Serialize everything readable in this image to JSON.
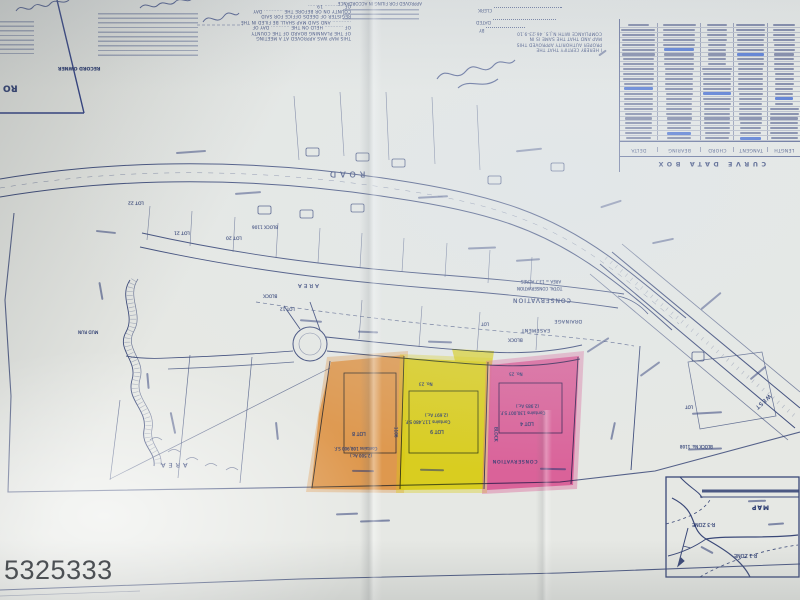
{
  "watermark": "5325333",
  "palette": {
    "paper": "#e6e8e4",
    "ink": "#3a4878",
    "highlight_orange": "#f59b3e",
    "highlight_yellow": "#f0df0c",
    "highlight_pink": "#f0569f",
    "watermark_color": "#414549"
  },
  "curve_table": {
    "title": "CURVE DATA BOX",
    "columns": [
      "DELTA",
      "BEARING",
      "CHORD",
      "TANGENT",
      "LENGTH"
    ],
    "row_count": 24,
    "note": "rows of tiny illegible curve numbers"
  },
  "certifications": {
    "planning_board_note": [
      "THIS MAP WAS APPROVED AT A MEETING",
      "OF THE PLANNING BOARD OF THE COUNTY",
      "OF ............ HELD ON THE ............ DAY OF",
      "............ AND SAID MAP SHALL BE FILED IN THE",
      "REGISTER OF DEEDS OFFICE FOR SAID",
      "COUNTY ON OR BEFORE THE ............ DAY",
      "OF ............ 19......"
    ],
    "authority_note": [
      "I HEREBY CERTIFY THAT THE",
      "PROPER AUTHORITY APPROVED THIS",
      "MAP AND THAT THE SAME IS IN",
      "COMPLIANCE WITH N.J.S. 46:23-9.10"
    ],
    "approved_note": "APPROVED FOR FILING IN ACCORDANCE",
    "clerk_label": "CLERK",
    "dated_label": "DATED",
    "by_label": "BY"
  },
  "highlighted_lots": [
    {
      "lot": "LOT 8",
      "block": "1106",
      "area_sf": "Contains 108,900 S.F.",
      "acres": "(2.500 Ac.)",
      "highlight": "orange"
    },
    {
      "lot": "LOT 9",
      "block": "1106",
      "area_sf": "Contains 117,480 S.F.",
      "acres": "(2.697 Ac.)",
      "highlight": "yellow"
    },
    {
      "lot": "LOT 4",
      "block": "1106",
      "area_sf": "Contains 130,007 S.F.",
      "acres": "(2.985 Ac.)",
      "highlight": "pink"
    }
  ],
  "inset": {
    "title": "MAP",
    "zones": [
      "R-3 ZONE",
      "R-1 ZONE"
    ]
  },
  "map_labels": [
    {
      "text": "ROAD",
      "x": 326,
      "y": 169,
      "fs": 8,
      "ls": 4,
      "name": "road-name-label"
    },
    {
      "text": "LOT 22",
      "x": 128,
      "y": 199,
      "fs": 4.5
    },
    {
      "text": "LOT 21",
      "x": 174,
      "y": 229,
      "fs": 4.5
    },
    {
      "text": "LOT 20",
      "x": 226,
      "y": 234,
      "fs": 4.5
    },
    {
      "text": "BLOCK 1106",
      "x": 252,
      "y": 224,
      "fs": 4.2,
      "name": "block-number-label"
    },
    {
      "text": "AREA",
      "x": 296,
      "y": 281,
      "fs": 5.5,
      "ls": 2
    },
    {
      "text": "BLOCK",
      "x": 263,
      "y": 292,
      "fs": 4.3
    },
    {
      "text": "LOT 12",
      "x": 280,
      "y": 306,
      "fs": 4.2
    },
    {
      "text": "AREA = 13.7 ACRES",
      "x": 521,
      "y": 279,
      "fs": 4
    },
    {
      "text": "TOTAL CONSERVATION",
      "x": 517,
      "y": 286,
      "fs": 4
    },
    {
      "text": "CONSERVATION",
      "x": 512,
      "y": 296,
      "fs": 6,
      "ls": 1,
      "name": "conservation-area-label"
    },
    {
      "text": "DRAINAGE",
      "x": 554,
      "y": 317,
      "fs": 4.6,
      "ls": 0.5
    },
    {
      "text": "EASEMENT",
      "x": 521,
      "y": 326,
      "fs": 4.6,
      "ls": 0.5
    },
    {
      "text": "LOT",
      "x": 481,
      "y": 321,
      "fs": 4.2
    },
    {
      "text": "BLOCK",
      "x": 508,
      "y": 336,
      "fs": 4.4
    },
    {
      "text": "No. 23",
      "x": 419,
      "y": 381,
      "fs": 4.2
    },
    {
      "text": "No. 25",
      "x": 509,
      "y": 371,
      "fs": 4.2
    },
    {
      "text": "(2.697 Ac.)",
      "x": 425,
      "y": 412,
      "fs": 4.2
    },
    {
      "text": "Contains 117,480 S.F.",
      "x": 405,
      "y": 419,
      "fs": 4.2
    },
    {
      "text": "LOT 9",
      "x": 430,
      "y": 428,
      "fs": 4.8,
      "name": "lot-9-label"
    },
    {
      "text": "LOT 8",
      "x": 352,
      "y": 430,
      "fs": 4.8,
      "name": "lot-8-label"
    },
    {
      "text": "Contains 108,900 S.F.",
      "x": 334,
      "y": 446,
      "fs": 4
    },
    {
      "text": "(2.500 Ac.)",
      "x": 350,
      "y": 453,
      "fs": 4
    },
    {
      "text": "(2.985 Ac.)",
      "x": 516,
      "y": 403,
      "fs": 4.2
    },
    {
      "text": "Contains 130,007 S.F.",
      "x": 500,
      "y": 410,
      "fs": 4.2
    },
    {
      "text": "LOT 4",
      "x": 520,
      "y": 420,
      "fs": 4.8,
      "name": "lot-4-label"
    },
    {
      "text": "BLOCK",
      "x": 487,
      "y": 432,
      "fs": 4.4,
      "rot": 90,
      "name": "block-label-vertical"
    },
    {
      "text": "1106",
      "x": 390,
      "y": 430,
      "fs": 4.2,
      "rot": 90
    },
    {
      "text": "CONSERVATION",
      "x": 492,
      "y": 457,
      "fs": 4.6,
      "ls": 0.8
    },
    {
      "text": "WEST",
      "x": 752,
      "y": 398,
      "fs": 5.5,
      "ls": 1,
      "rot": 138,
      "name": "west-road-label"
    },
    {
      "text": "LOT",
      "x": 685,
      "y": 404,
      "fs": 4.2
    },
    {
      "text": "BLOCK No. 1108",
      "x": 680,
      "y": 444,
      "fs": 4
    },
    {
      "text": "MUD RUN",
      "x": 78,
      "y": 329,
      "fs": 4.2,
      "name": "stream-label"
    },
    {
      "text": "AREA",
      "x": 158,
      "y": 461,
      "fs": 6.5,
      "ls": 3
    },
    {
      "text": "MAP",
      "x": 751,
      "y": 503,
      "fs": 6,
      "ls": 1,
      "cls": "b",
      "name": "inset-map-title"
    },
    {
      "text": "R-3 ZONE",
      "x": 692,
      "y": 521,
      "fs": 4.8,
      "name": "zone-r3-label"
    },
    {
      "text": "R-1 ZONE",
      "x": 734,
      "y": 552,
      "fs": 4.8,
      "name": "zone-r1-label"
    },
    {
      "text": "RO",
      "x": 3,
      "y": 82,
      "fs": 9,
      "cls": "b",
      "name": "corner-box-text"
    },
    {
      "text": "RECORD OWNER",
      "x": 58,
      "y": 64,
      "fs": 4.6,
      "cls": "b",
      "name": "record-owner-label"
    }
  ],
  "smudges": [
    {
      "x": 235,
      "y": 192,
      "w": 26,
      "r": -4
    },
    {
      "x": 418,
      "y": 196,
      "w": 30,
      "r": -3
    },
    {
      "x": 468,
      "y": 247,
      "w": 28,
      "r": -2
    },
    {
      "x": 516,
      "y": 259,
      "w": 24,
      "r": -4
    },
    {
      "x": 96,
      "y": 231,
      "w": 20,
      "r": 6
    },
    {
      "x": 176,
      "y": 151,
      "w": 30,
      "r": -4
    },
    {
      "x": 516,
      "y": 149,
      "w": 26,
      "r": -6
    },
    {
      "x": 600,
      "y": 203,
      "w": 22,
      "r": -18
    },
    {
      "x": 652,
      "y": 240,
      "w": 22,
      "r": -12
    },
    {
      "x": 300,
      "y": 320,
      "w": 22,
      "r": 4
    },
    {
      "x": 358,
      "y": 331,
      "w": 20,
      "r": 2
    },
    {
      "x": 428,
      "y": 341,
      "w": 24,
      "r": 2
    },
    {
      "x": 585,
      "y": 344,
      "w": 26,
      "r": -33
    },
    {
      "x": 638,
      "y": 368,
      "w": 24,
      "r": -36
    },
    {
      "x": 698,
      "y": 300,
      "w": 26,
      "r": -40
    },
    {
      "x": 748,
      "y": 372,
      "w": 20,
      "r": -40
    },
    {
      "x": 692,
      "y": 412,
      "w": 30,
      "r": -3
    },
    {
      "x": 688,
      "y": 448,
      "w": 34,
      "r": -2
    },
    {
      "x": 604,
      "y": 430,
      "w": 18,
      "r": -78
    },
    {
      "x": 162,
      "y": 422,
      "w": 22,
      "r": 78
    },
    {
      "x": 268,
      "y": 430,
      "w": 18,
      "r": 84
    },
    {
      "x": 540,
      "y": 468,
      "w": 26,
      "r": 1
    },
    {
      "x": 420,
      "y": 469,
      "w": 24,
      "r": 1
    },
    {
      "x": 352,
      "y": 470,
      "w": 22,
      "r": 1
    },
    {
      "x": 360,
      "y": 520,
      "w": 30,
      "r": -2
    },
    {
      "x": 336,
      "y": 513,
      "w": 22,
      "r": -2
    },
    {
      "x": 748,
      "y": 500,
      "w": 18,
      "r": -2
    },
    {
      "x": 700,
      "y": 549,
      "w": 14,
      "r": 28
    },
    {
      "x": 768,
      "y": 523,
      "w": 16,
      "r": -4
    },
    {
      "x": 92,
      "y": 290,
      "w": 18,
      "r": 80
    },
    {
      "x": 140,
      "y": 380,
      "w": 16,
      "r": 85
    },
    {
      "x": 598,
      "y": 52,
      "w": 9,
      "r": -35
    }
  ]
}
